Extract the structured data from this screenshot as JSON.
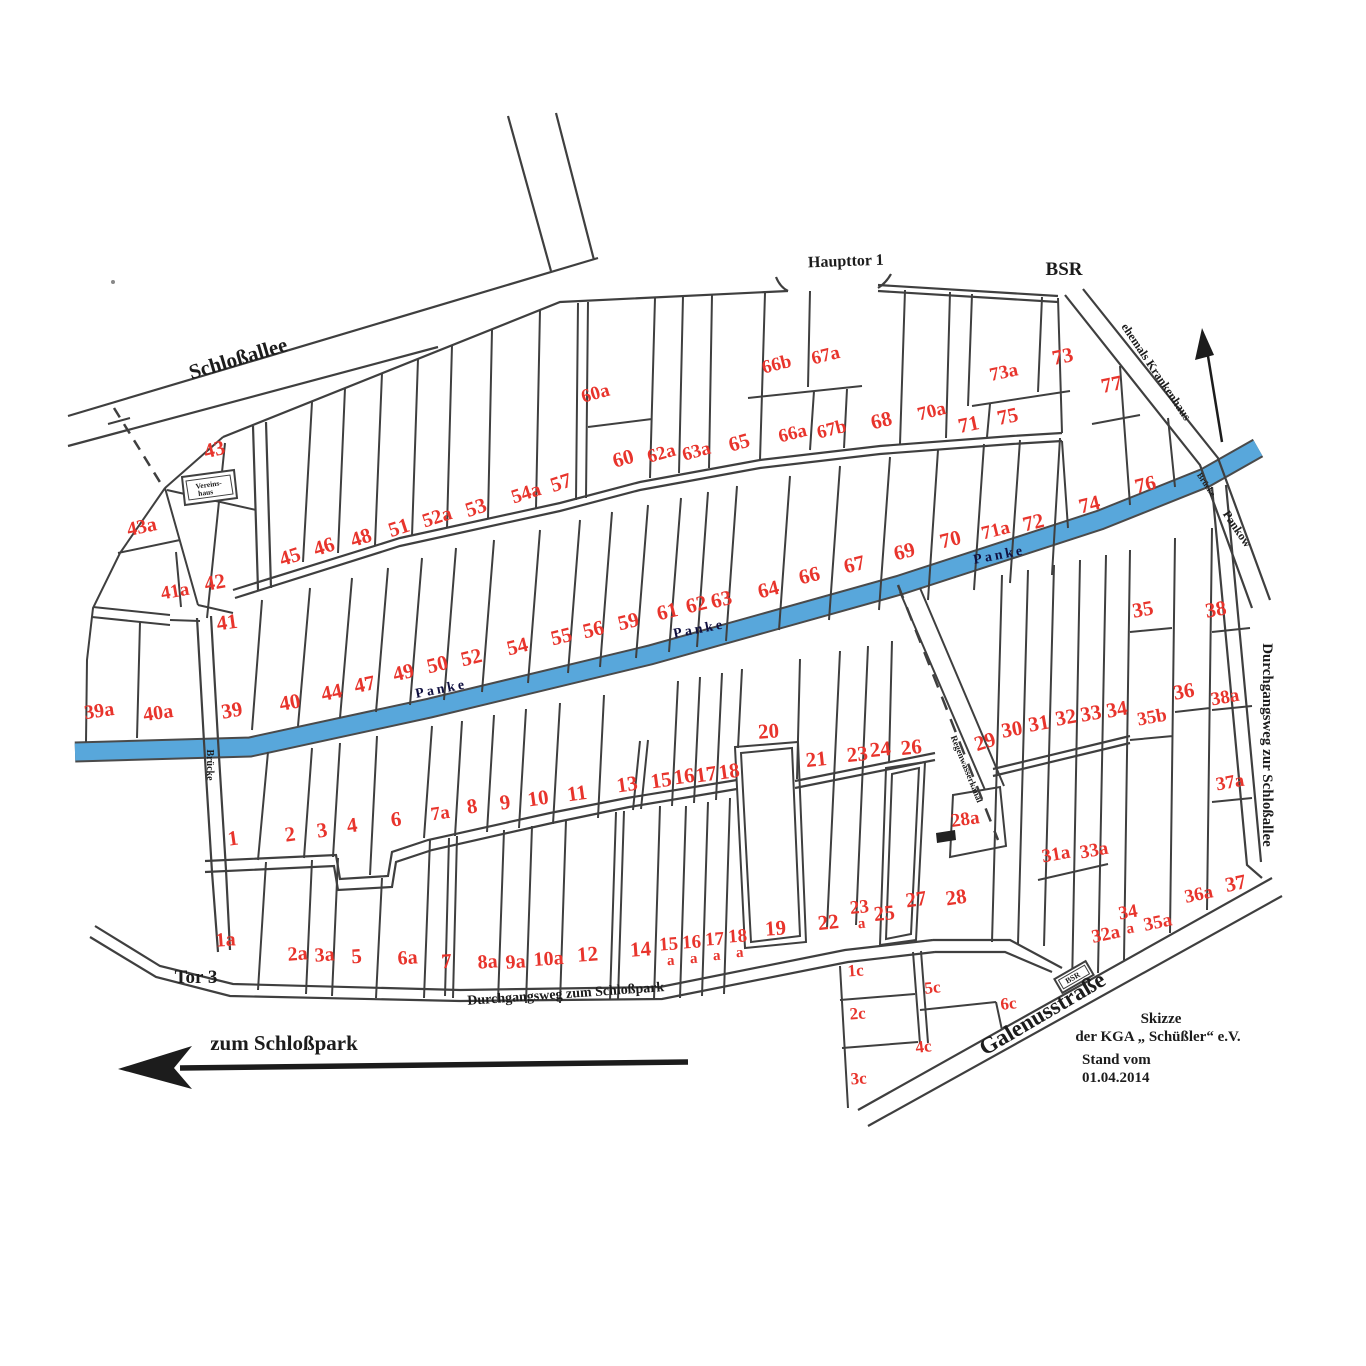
{
  "legend": {
    "lines": [
      "Skizze",
      "der KGA „ Schüßler“ e.V.",
      "Stand vom",
      "01.04.2014"
    ]
  },
  "map": {
    "colors": {
      "red": "#e8342c",
      "river": "#58a7db",
      "line": "#3f3f3f",
      "panke_text": "#101040",
      "street_text": "#1c1c1c"
    },
    "plots": [
      {
        "t": "43",
        "x": 216,
        "y": 456,
        "r": -14
      },
      {
        "t": "43a",
        "x": 143,
        "y": 533,
        "r": -12,
        "s": 20
      },
      {
        "t": "42",
        "x": 216,
        "y": 589,
        "r": -10
      },
      {
        "t": "41a",
        "x": 176,
        "y": 597,
        "r": -10,
        "s": 19
      },
      {
        "t": "41",
        "x": 228,
        "y": 629,
        "r": -8
      },
      {
        "t": "39a",
        "x": 100,
        "y": 717,
        "r": -8,
        "s": 20
      },
      {
        "t": "40a",
        "x": 159,
        "y": 719,
        "r": -8,
        "s": 20
      },
      {
        "t": "39",
        "x": 233,
        "y": 717,
        "r": -10
      },
      {
        "t": "40",
        "x": 291,
        "y": 709,
        "r": -10
      },
      {
        "t": "44",
        "x": 333,
        "y": 699,
        "r": -12
      },
      {
        "t": "47",
        "x": 366,
        "y": 691,
        "r": -12
      },
      {
        "t": "45",
        "x": 292,
        "y": 563,
        "r": -18
      },
      {
        "t": "46",
        "x": 326,
        "y": 553,
        "r": -18
      },
      {
        "t": "48",
        "x": 363,
        "y": 544,
        "r": -18
      },
      {
        "t": "51",
        "x": 401,
        "y": 534,
        "r": -18
      },
      {
        "t": "52a",
        "x": 439,
        "y": 523,
        "r": -18,
        "s": 20
      },
      {
        "t": "53",
        "x": 478,
        "y": 514,
        "r": -18
      },
      {
        "t": "54a",
        "x": 528,
        "y": 499,
        "r": -18,
        "s": 20
      },
      {
        "t": "57",
        "x": 563,
        "y": 489,
        "r": -18
      },
      {
        "t": "49",
        "x": 405,
        "y": 679,
        "r": -14
      },
      {
        "t": "50",
        "x": 439,
        "y": 671,
        "r": -14
      },
      {
        "t": "52",
        "x": 473,
        "y": 664,
        "r": -14
      },
      {
        "t": "54",
        "x": 519,
        "y": 653,
        "r": -14
      },
      {
        "t": "55",
        "x": 563,
        "y": 643,
        "r": -14
      },
      {
        "t": "56",
        "x": 595,
        "y": 636,
        "r": -14
      },
      {
        "t": "59",
        "x": 630,
        "y": 628,
        "r": -14
      },
      {
        "t": "61",
        "x": 669,
        "y": 618,
        "r": -14
      },
      {
        "t": "62",
        "x": 698,
        "y": 611,
        "r": -14
      },
      {
        "t": "63",
        "x": 723,
        "y": 606,
        "r": -14
      },
      {
        "t": "64",
        "x": 770,
        "y": 596,
        "r": -14
      },
      {
        "t": "66",
        "x": 811,
        "y": 582,
        "r": -14
      },
      {
        "t": "67",
        "x": 856,
        "y": 571,
        "r": -14
      },
      {
        "t": "69",
        "x": 906,
        "y": 558,
        "r": -14
      },
      {
        "t": "70",
        "x": 952,
        "y": 546,
        "r": -14
      },
      {
        "t": "71a",
        "x": 997,
        "y": 536,
        "r": -14,
        "s": 19
      },
      {
        "t": "72",
        "x": 1035,
        "y": 529,
        "r": -14
      },
      {
        "t": "74",
        "x": 1091,
        "y": 511,
        "r": -14
      },
      {
        "t": "76",
        "x": 1147,
        "y": 491,
        "r": -14
      },
      {
        "t": "60a",
        "x": 597,
        "y": 399,
        "r": -16,
        "s": 19
      },
      {
        "t": "60",
        "x": 625,
        "y": 465,
        "r": -16
      },
      {
        "t": "62a",
        "x": 663,
        "y": 459,
        "r": -16,
        "s": 19
      },
      {
        "t": "63a",
        "x": 698,
        "y": 457,
        "r": -16,
        "s": 19
      },
      {
        "t": "65",
        "x": 741,
        "y": 449,
        "r": -16
      },
      {
        "t": "66a",
        "x": 794,
        "y": 439,
        "r": -14,
        "s": 19
      },
      {
        "t": "67b",
        "x": 833,
        "y": 435,
        "r": -14,
        "s": 19
      },
      {
        "t": "68",
        "x": 883,
        "y": 427,
        "r": -14
      },
      {
        "t": "70a",
        "x": 933,
        "y": 417,
        "r": -14,
        "s": 19
      },
      {
        "t": "71",
        "x": 970,
        "y": 431,
        "r": -12
      },
      {
        "t": "75",
        "x": 1009,
        "y": 423,
        "r": -12
      },
      {
        "t": "66b",
        "x": 778,
        "y": 370,
        "r": -14,
        "s": 19
      },
      {
        "t": "67a",
        "x": 827,
        "y": 361,
        "r": -14,
        "s": 19
      },
      {
        "t": "73a",
        "x": 1005,
        "y": 378,
        "r": -12,
        "s": 19
      },
      {
        "t": "73",
        "x": 1064,
        "y": 363,
        "r": -12
      },
      {
        "t": "77",
        "x": 1113,
        "y": 391,
        "r": -12
      },
      {
        "t": "1",
        "x": 234,
        "y": 845,
        "r": -8
      },
      {
        "t": "2",
        "x": 291,
        "y": 841,
        "r": -8
      },
      {
        "t": "3",
        "x": 323,
        "y": 837,
        "r": -8
      },
      {
        "t": "4",
        "x": 353,
        "y": 832,
        "r": -8
      },
      {
        "t": "6",
        "x": 397,
        "y": 826,
        "r": -8
      },
      {
        "t": "7a",
        "x": 441,
        "y": 819,
        "r": -8,
        "s": 19
      },
      {
        "t": "8",
        "x": 473,
        "y": 813,
        "r": -8
      },
      {
        "t": "9",
        "x": 506,
        "y": 809,
        "r": -8
      },
      {
        "t": "10",
        "x": 539,
        "y": 805,
        "r": -8
      },
      {
        "t": "11",
        "x": 578,
        "y": 800,
        "r": -8
      },
      {
        "t": "13",
        "x": 628,
        "y": 791,
        "r": -8
      },
      {
        "t": "15",
        "x": 662,
        "y": 787,
        "r": -8
      },
      {
        "t": "16",
        "x": 685,
        "y": 783,
        "r": -8
      },
      {
        "t": "17",
        "x": 707,
        "y": 781,
        "r": -8
      },
      {
        "t": "18",
        "x": 730,
        "y": 778,
        "r": -8
      },
      {
        "t": "20",
        "x": 769,
        "y": 738,
        "r": -4
      },
      {
        "t": "21",
        "x": 817,
        "y": 766,
        "r": -6
      },
      {
        "t": "23",
        "x": 858,
        "y": 761,
        "r": -6
      },
      {
        "t": "24",
        "x": 881,
        "y": 756,
        "r": -6
      },
      {
        "t": "26",
        "x": 912,
        "y": 754,
        "r": -6
      },
      {
        "t": "29",
        "x": 987,
        "y": 748,
        "r": -18
      },
      {
        "t": "30",
        "x": 1013,
        "y": 736,
        "r": -10
      },
      {
        "t": "31",
        "x": 1040,
        "y": 730,
        "r": -10
      },
      {
        "t": "32",
        "x": 1067,
        "y": 724,
        "r": -10
      },
      {
        "t": "33",
        "x": 1092,
        "y": 720,
        "r": -10
      },
      {
        "t": "34",
        "x": 1118,
        "y": 716,
        "r": -10
      },
      {
        "t": "35b",
        "x": 1153,
        "y": 723,
        "r": -10,
        "s": 19
      },
      {
        "t": "35",
        "x": 1144,
        "y": 616,
        "r": -10
      },
      {
        "t": "38",
        "x": 1217,
        "y": 616,
        "r": -10
      },
      {
        "t": "36",
        "x": 1185,
        "y": 698,
        "r": -10
      },
      {
        "t": "38a",
        "x": 1226,
        "y": 703,
        "r": -10,
        "s": 19
      },
      {
        "t": "37a",
        "x": 1231,
        "y": 788,
        "r": -10,
        "s": 19
      },
      {
        "t": "1a",
        "x": 226,
        "y": 946,
        "r": -4,
        "s": 20
      },
      {
        "t": "2a",
        "x": 298,
        "y": 960,
        "r": -4,
        "s": 20
      },
      {
        "t": "3a",
        "x": 325,
        "y": 961,
        "r": -4,
        "s": 20
      },
      {
        "t": "5",
        "x": 357,
        "y": 963,
        "r": -4
      },
      {
        "t": "6a",
        "x": 408,
        "y": 964,
        "r": -4,
        "s": 20
      },
      {
        "t": "7",
        "x": 447,
        "y": 968,
        "r": -4
      },
      {
        "t": "8a",
        "x": 488,
        "y": 968,
        "r": -4,
        "s": 20
      },
      {
        "t": "9a",
        "x": 516,
        "y": 968,
        "r": -4,
        "s": 20
      },
      {
        "t": "10a",
        "x": 549,
        "y": 965,
        "r": -4,
        "s": 20
      },
      {
        "t": "12",
        "x": 588,
        "y": 961,
        "r": -4
      },
      {
        "t": "14",
        "x": 641,
        "y": 956,
        "r": -4
      },
      {
        "t": "19",
        "x": 776,
        "y": 935,
        "r": -4
      },
      {
        "t": "22",
        "x": 829,
        "y": 929,
        "r": -6
      },
      {
        "t": "25",
        "x": 885,
        "y": 920,
        "r": -6
      },
      {
        "t": "27",
        "x": 917,
        "y": 906,
        "r": -8
      },
      {
        "t": "28",
        "x": 957,
        "y": 904,
        "r": -8
      },
      {
        "t": "28a",
        "x": 966,
        "y": 825,
        "r": -8,
        "s": 19
      },
      {
        "t": "31a",
        "x": 1057,
        "y": 860,
        "r": -10,
        "s": 19
      },
      {
        "t": "33a",
        "x": 1095,
        "y": 856,
        "r": -10,
        "s": 19
      },
      {
        "t": "32a",
        "x": 1107,
        "y": 940,
        "r": -12,
        "s": 19
      },
      {
        "t": "35a",
        "x": 1159,
        "y": 928,
        "r": -12,
        "s": 19
      },
      {
        "t": "36a",
        "x": 1200,
        "y": 900,
        "r": -12,
        "s": 19
      },
      {
        "t": "37",
        "x": 1237,
        "y": 890,
        "r": -12
      },
      {
        "t": "1c",
        "x": 856,
        "y": 976,
        "r": -4,
        "s": 17
      },
      {
        "t": "2c",
        "x": 858,
        "y": 1019,
        "r": -4,
        "s": 17
      },
      {
        "t": "3c",
        "x": 859,
        "y": 1084,
        "r": -4,
        "s": 17
      },
      {
        "t": "4c",
        "x": 924,
        "y": 1052,
        "r": -6,
        "s": 17
      },
      {
        "t": "5c",
        "x": 933,
        "y": 993,
        "r": -6,
        "s": 17
      },
      {
        "t": "6c",
        "x": 1009,
        "y": 1009,
        "r": -6,
        "s": 17
      }
    ],
    "stacked_plots": [
      {
        "t": "15",
        "t2": "a",
        "x": 669,
        "y": 950,
        "r": -4
      },
      {
        "t": "16",
        "t2": "a",
        "x": 692,
        "y": 948,
        "r": -4
      },
      {
        "t": "17",
        "t2": "a",
        "x": 715,
        "y": 945,
        "r": -4
      },
      {
        "t": "18",
        "t2": "a",
        "x": 738,
        "y": 942,
        "r": -4
      },
      {
        "t": "23",
        "t2": "a",
        "x": 860,
        "y": 913,
        "r": -6
      },
      {
        "t": "34",
        "t2": "a",
        "x": 1129,
        "y": 918,
        "r": -10
      }
    ],
    "streets": [
      {
        "t": "Schloßallee",
        "x": 240,
        "y": 365,
        "r": -16.5,
        "s": 21
      },
      {
        "t": "Haupttor 1",
        "x": 846,
        "y": 266,
        "r": -2,
        "s": 16
      },
      {
        "t": "BSR",
        "x": 1064,
        "y": 275,
        "r": 0,
        "s": 19
      },
      {
        "t": "ehemals Krankenhaus",
        "x": 1153,
        "y": 374,
        "r": 56,
        "s": 12
      },
      {
        "t": "Pankow",
        "x": 1234,
        "y": 531,
        "r": 56,
        "s": 12
      },
      {
        "t": "Brücke",
        "x": 1204,
        "y": 486,
        "r": 56,
        "s": 8.5
      },
      {
        "t": "Brücke",
        "x": 207,
        "y": 765,
        "r": 90,
        "s": 10
      },
      {
        "t": "Panke",
        "x": 442,
        "y": 693,
        "r": -11,
        "s": 14,
        "ls": 3,
        "c": "#101040"
      },
      {
        "t": "Panke",
        "x": 700,
        "y": 633,
        "r": -11,
        "s": 14,
        "ls": 3,
        "c": "#101040"
      },
      {
        "t": "Panke",
        "x": 1000,
        "y": 559,
        "r": -11,
        "s": 14,
        "ls": 3,
        "c": "#101040"
      },
      {
        "t": "Regenwasserkanal",
        "x": 964,
        "y": 770,
        "r": 68,
        "s": 9
      },
      {
        "t": "Durchgangsweg zum Schloßpark",
        "x": 566,
        "y": 998,
        "r": -4,
        "s": 14
      },
      {
        "t": "Tor 3",
        "x": 196,
        "y": 983,
        "r": 0,
        "s": 19
      },
      {
        "t": "zum Schloßpark",
        "x": 284,
        "y": 1050,
        "r": 0,
        "s": 21
      },
      {
        "t": "Galenusstraße",
        "x": 1046,
        "y": 1020,
        "r": -30.5,
        "s": 23
      },
      {
        "t": "Durchgangsweg zur Schloßallee",
        "x": 1263,
        "y": 745,
        "r": 90,
        "s": 15
      },
      {
        "t": "Vereins-",
        "x": 209,
        "y": 487,
        "r": -8,
        "s": 7.5
      },
      {
        "t": "haus",
        "x": 206,
        "y": 495,
        "r": -8,
        "s": 7.5
      },
      {
        "t": "BSR",
        "x": 1074,
        "y": 980,
        "r": -30,
        "s": 8
      }
    ]
  }
}
